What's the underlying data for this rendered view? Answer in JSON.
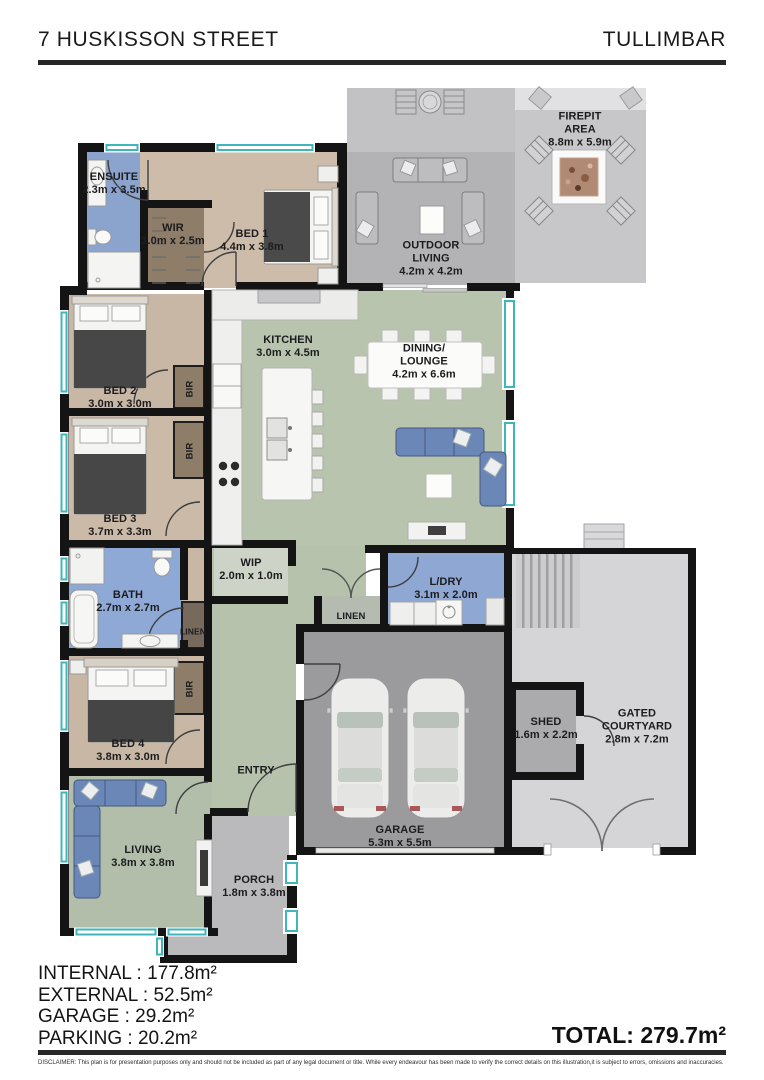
{
  "header": {
    "address": "7 HUSKISSON STREET",
    "suburb": "TULLIMBAR"
  },
  "rooms": {
    "firepit": {
      "name": "FIREPIT",
      "name2": "AREA",
      "dims": "8.8m x 5.9m"
    },
    "outdoor": {
      "name": "OUTDOOR",
      "name2": "LIVING",
      "dims": "4.2m x 4.2m"
    },
    "ensuite": {
      "name": "ENSUITE",
      "dims": "2.3m x 3.5m"
    },
    "wir": {
      "name": "WIR",
      "dims": "1.0m x 2.5m"
    },
    "bed1": {
      "name": "BED 1",
      "dims": "4.4m x 3.8m"
    },
    "bed2": {
      "name": "BED 2",
      "dims": "3.0m x 3.0m"
    },
    "bed3": {
      "name": "BED 3",
      "dims": "3.7m x 3.3m"
    },
    "bed4": {
      "name": "BED 4",
      "dims": "3.8m x 3.0m"
    },
    "bath": {
      "name": "BATH",
      "dims": "2.7m x 2.7m"
    },
    "kitchen": {
      "name": "KITCHEN",
      "dims": "3.0m x 4.5m"
    },
    "dining": {
      "name": "DINING/",
      "name2": "LOUNGE",
      "dims": "4.2m x 6.6m"
    },
    "wip": {
      "name": "WIP",
      "dims": "2.0m x 1.0m"
    },
    "ldry": {
      "name": "L/DRY",
      "dims": "3.1m x 2.0m"
    },
    "linen": {
      "name": "LINEN"
    },
    "bir": {
      "name": "BIR"
    },
    "living": {
      "name": "LIVING",
      "dims": "3.8m x 3.8m"
    },
    "entry": {
      "name": "ENTRY"
    },
    "garage": {
      "name": "GARAGE",
      "dims": "5.3m x 5.5m"
    },
    "porch": {
      "name": "PORCH",
      "dims": "1.8m x 3.8m"
    },
    "shed": {
      "name": "SHED",
      "dims": "1.6m x 2.2m"
    },
    "courtyard": {
      "name": "GATED",
      "name2": "COURTYARD",
      "dims": "2.8m x 7.2m"
    }
  },
  "summary": {
    "lines": {
      "internal": "INTERNAL : 177.8m²",
      "external": "EXTERNAL : 52.5m²",
      "garage": "GARAGE : 29.2m²",
      "parking": "PARKING : 20.2m²"
    },
    "total": "TOTAL: 279.7m²"
  },
  "disclaimer": "DISCLAIMER: This plan is for presentation purposes only and should not be included as part of any legal document or title. While every endeavour has been made to verify the correct details on this illustration,it is subject to errors, omissions and inaccuracies.",
  "colors": {
    "walls": "#141414",
    "window_teal": "#3fb5bd",
    "bedroom_tan": "#cbbaa8",
    "wet_area_blue": "#8fa8d3",
    "living_green": "#b8c3ae",
    "robe_brown": "#8d7d69",
    "outdoor_grey": "#b4b4b6",
    "garage_grey": "#9b9b9d",
    "courtyard_grey": "#d5d5d7"
  }
}
